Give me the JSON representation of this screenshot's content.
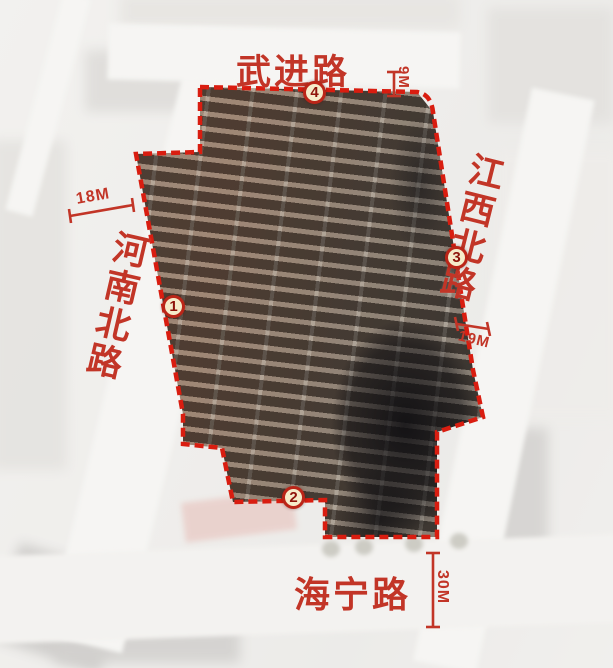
{
  "roads": {
    "top": {
      "label": "武进路"
    },
    "right": {
      "label": "江西北路"
    },
    "left": {
      "label": "河南北路"
    },
    "bottom": {
      "label": "海宁路"
    }
  },
  "dimensions": {
    "left": {
      "label": "18M"
    },
    "top": {
      "label": "9M"
    },
    "right": {
      "label": "19M"
    },
    "bottom": {
      "label": "30M"
    }
  },
  "markers": {
    "m1": {
      "label": "1"
    },
    "m2": {
      "label": "2"
    },
    "m3": {
      "label": "3"
    },
    "m4": {
      "label": "4"
    }
  },
  "colors": {
    "boundary_red": "#d91d10",
    "label_red": "#c23527",
    "marker_fill": "#f6ecca",
    "marker_border": "#bb2518",
    "marker_number": "#8e140b"
  }
}
